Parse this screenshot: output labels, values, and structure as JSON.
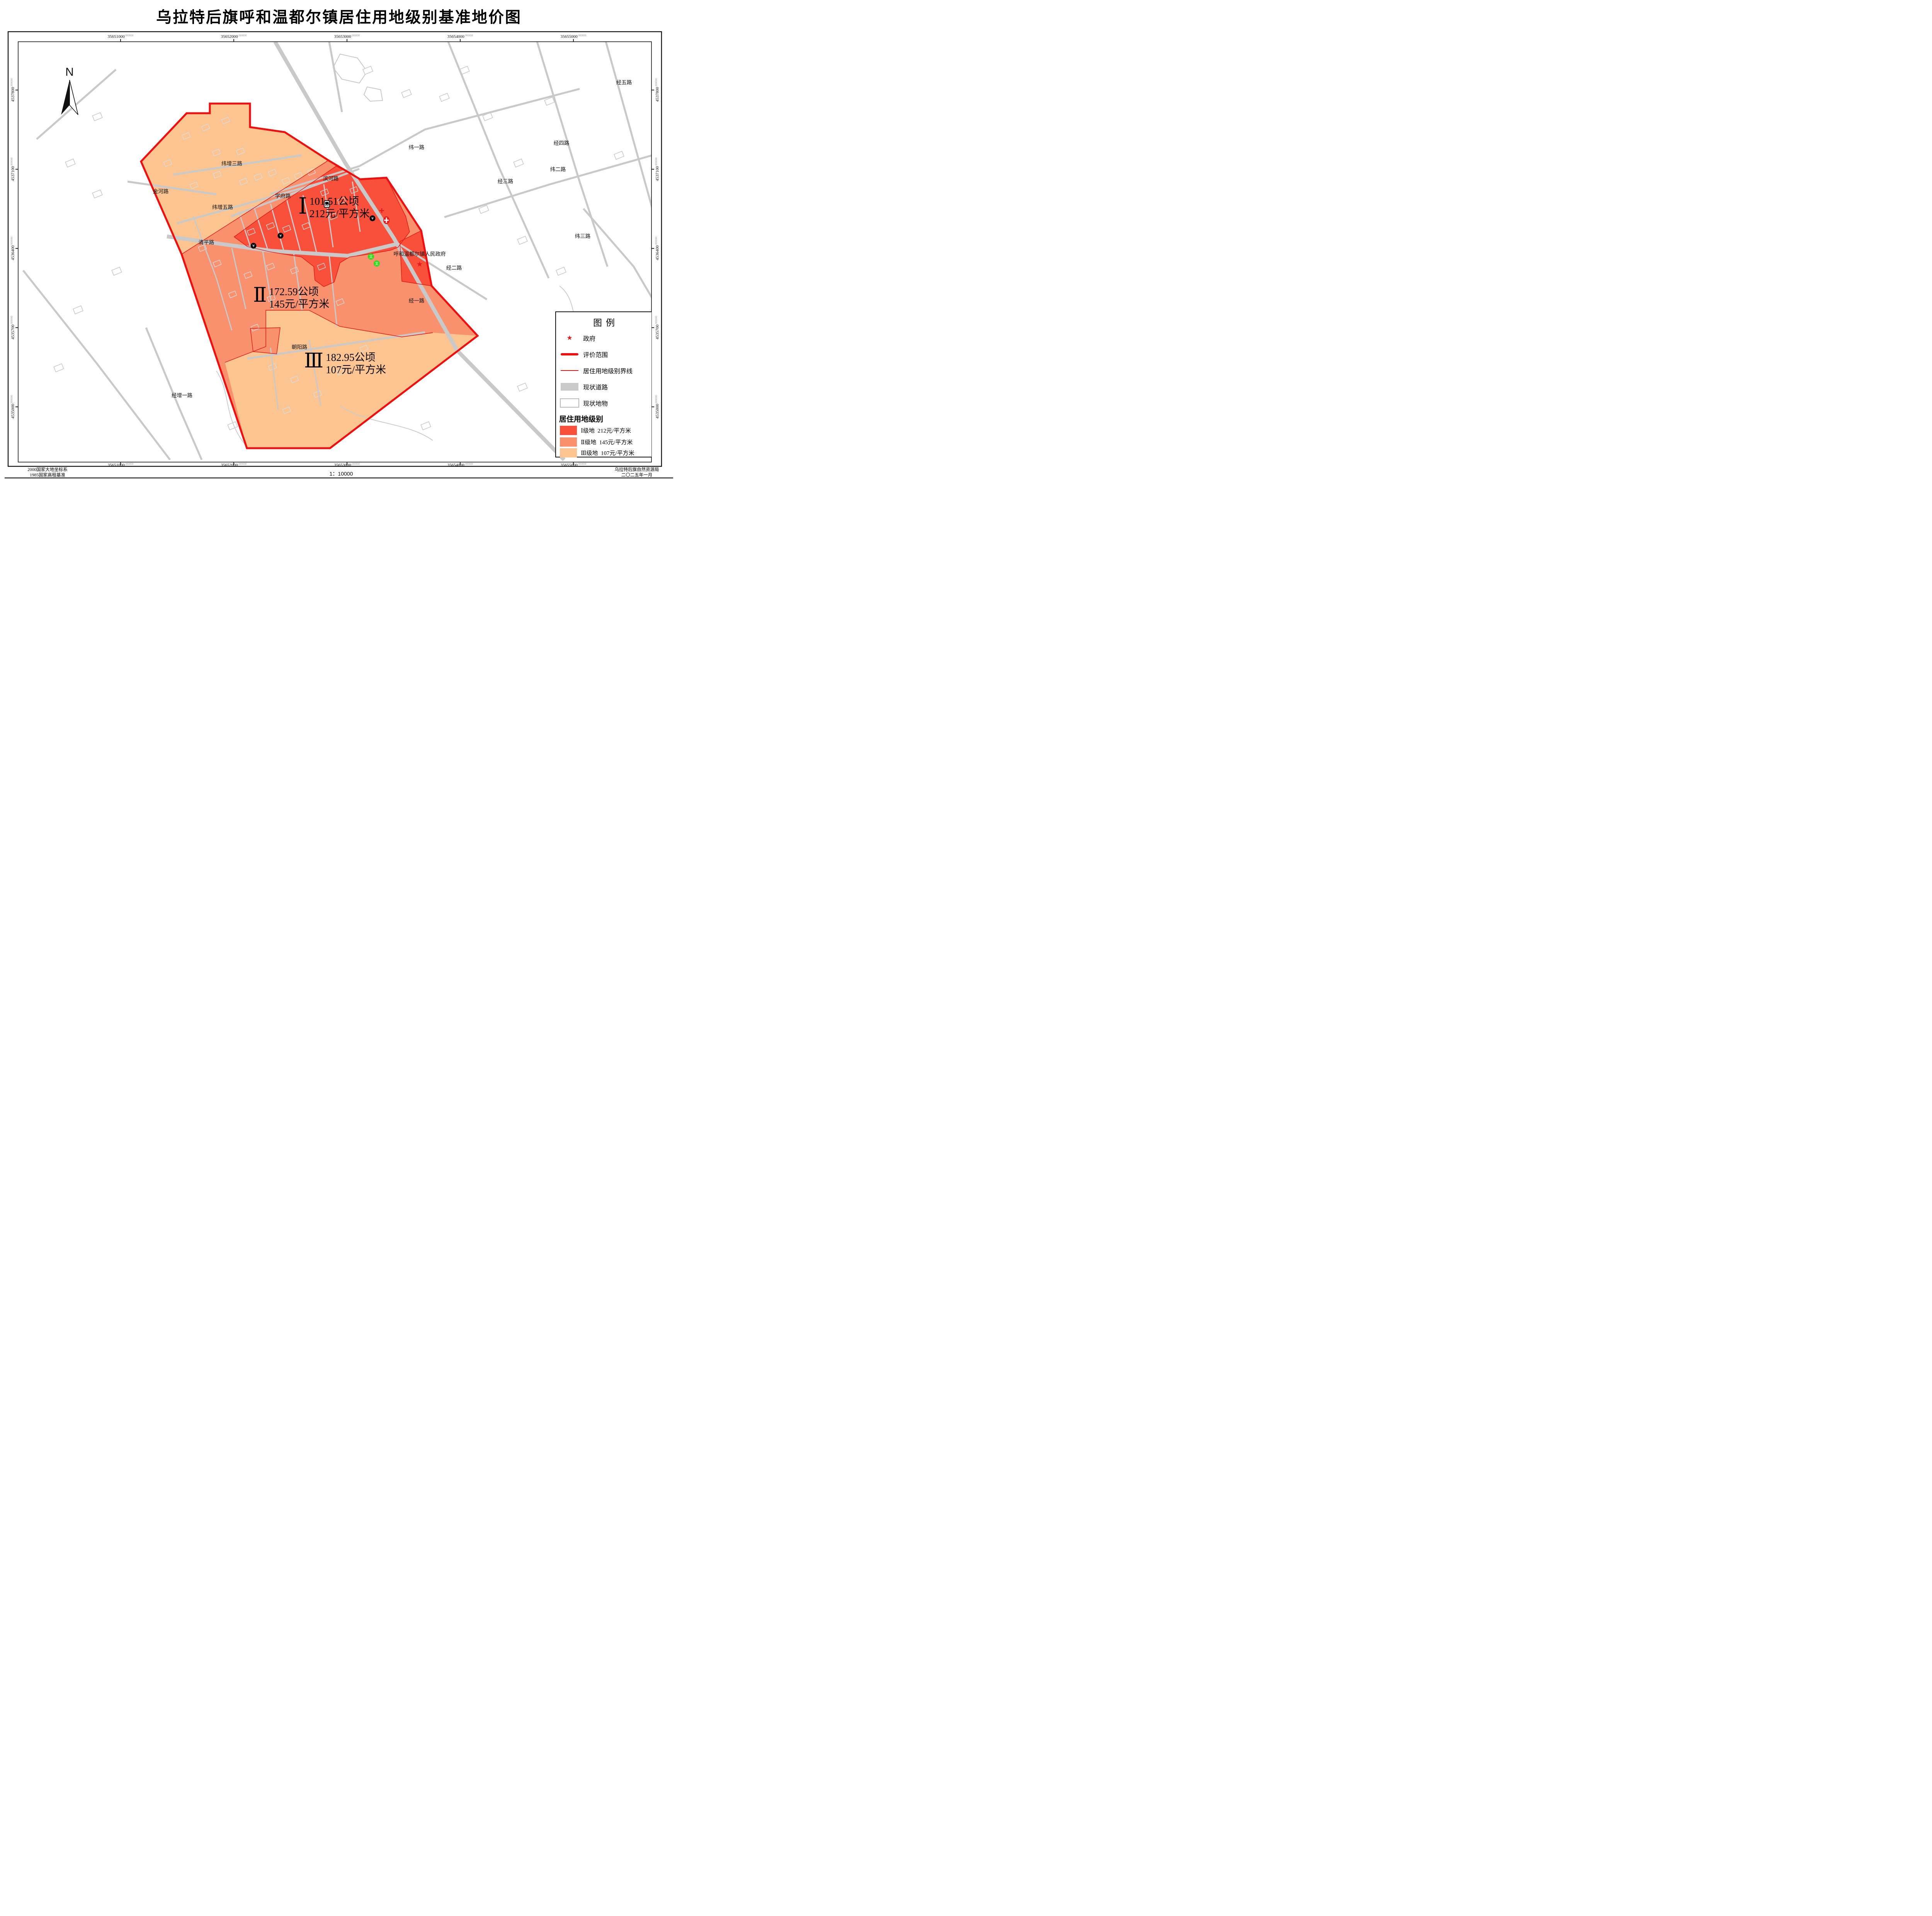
{
  "title": "乌拉特后旗呼和温都尔镇居住用地级别基准地价图",
  "north_indicator": "N",
  "grid": {
    "x_labels": [
      "35651000",
      "35652000",
      "35653000",
      "35654000",
      "35655000"
    ],
    "y_labels": [
      "4537800",
      "4537100",
      "4536400",
      "4535700",
      "4535000"
    ],
    "decimal_suffix": ".000000"
  },
  "zones": [
    {
      "numeral": "Ⅰ",
      "name": "Ⅰ级地",
      "area": "101.51公顷",
      "price": "212元/平方米",
      "color": "#F8503A"
    },
    {
      "numeral": "Ⅱ",
      "name": "Ⅱ级地",
      "area": "172.59公顷",
      "price": "145元/平方米",
      "color": "#F9906E"
    },
    {
      "numeral": "Ⅲ",
      "name": "Ⅲ级地",
      "area": "182.95公顷",
      "price": "107元/平方米",
      "color": "#FBC491"
    }
  ],
  "road_labels": [
    "纬增三路",
    "金河路",
    "纬增五路",
    "清平路",
    "学府路",
    "滨河路",
    "朝阳路",
    "经增一路",
    "纬一路",
    "纬二路",
    "纬三路",
    "经一路",
    "经二路",
    "经三路",
    "经四路",
    "经五路",
    "纬"
  ],
  "poi": {
    "government": "呼和温都尔镇人民政府"
  },
  "legend": {
    "title": "图例",
    "items": [
      {
        "label": "政府"
      },
      {
        "label": "评价范围"
      },
      {
        "label": "居住用地级别界线"
      },
      {
        "label": "现状道路"
      },
      {
        "label": "现状地物"
      }
    ],
    "section_title": "居住用地级别"
  },
  "footer": {
    "datum_line1": "2000国家大地坐标系",
    "datum_line2": "1985国家高程基准",
    "scale_text": "1：10000",
    "agency": "乌拉特后旗自然资源局",
    "date": "二〇二五年一月"
  },
  "colors": {
    "boundary": "#EE1010",
    "zone_line": "#E01515",
    "road": "#C9C9C9",
    "star": "#E31A1C",
    "school_green": "#35D91E"
  }
}
